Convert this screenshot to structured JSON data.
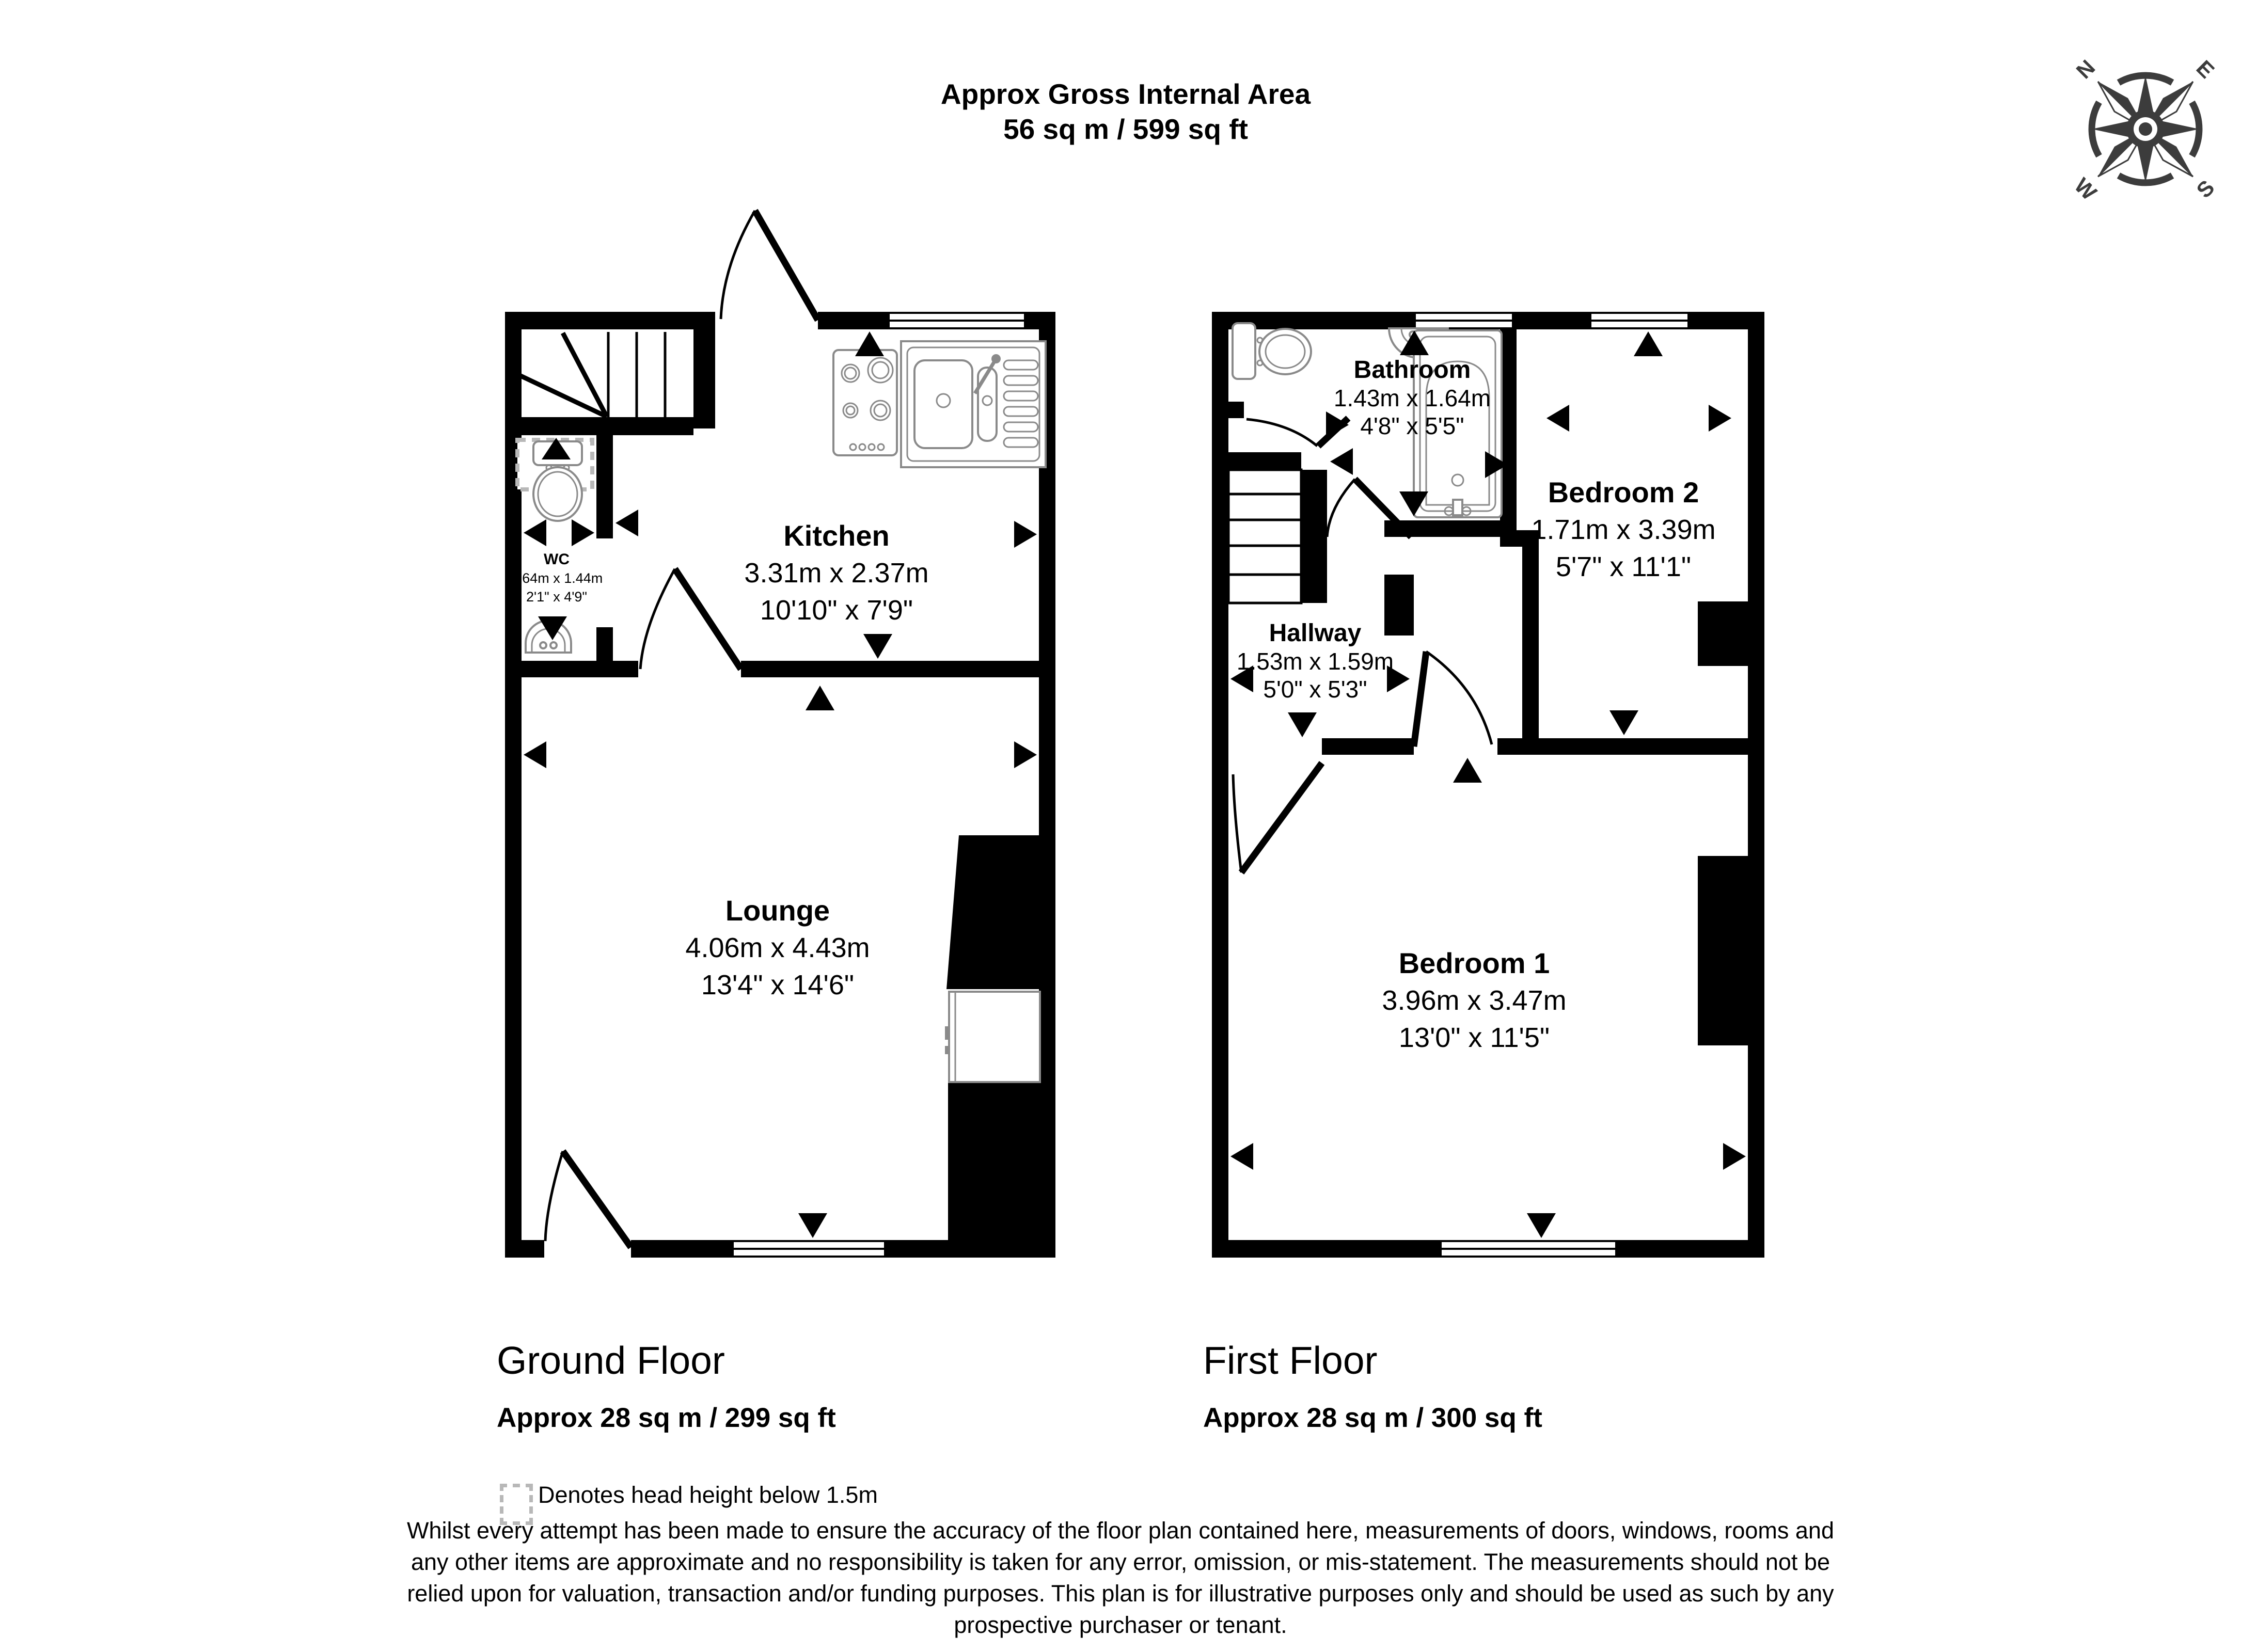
{
  "header": {
    "title_line1": "Approx Gross Internal Area",
    "title_line2": "56 sq m / 599 sq ft"
  },
  "compass": {
    "n": "N",
    "e": "E",
    "s": "S",
    "w": "W"
  },
  "ground_floor": {
    "name": "Ground Floor",
    "area": "Approx 28 sq m / 299 sq ft",
    "rooms": {
      "kitchen": {
        "name": "Kitchen",
        "metric": "3.31m x 2.37m",
        "imperial": "10'10\" x 7'9\""
      },
      "wc": {
        "name": "WC",
        "metric": "0.64m x 1.44m",
        "imperial": "2'1\" x 4'9\""
      },
      "lounge": {
        "name": "Lounge",
        "metric": "4.06m x 4.43m",
        "imperial": "13'4\" x 14'6\""
      }
    }
  },
  "first_floor": {
    "name": "First Floor",
    "area": "Approx 28 sq m / 300 sq ft",
    "rooms": {
      "bathroom": {
        "name": "Bathroom",
        "metric": "1.43m x 1.64m",
        "imperial": "4'8\" x 5'5\""
      },
      "bedroom2": {
        "name": "Bedroom 2",
        "metric": "1.71m x 3.39m",
        "imperial": "5'7\" x 11'1\""
      },
      "hallway": {
        "name": "Hallway",
        "metric": "1.53m x 1.59m",
        "imperial": "5'0\" x 5'3\""
      },
      "bedroom1": {
        "name": "Bedroom 1",
        "metric": "3.96m x 3.47m",
        "imperial": "13'0\" x 11'5\""
      }
    }
  },
  "legend": {
    "head_height": "Denotes head height below 1.5m"
  },
  "disclaimer": {
    "lines": [
      "Whilst every attempt has been made to ensure the accuracy of the floor plan contained here, measurements of doors, windows, rooms and",
      "any other items are approximate and no responsibility is taken for any error, omission, or mis-statement. The measurements should not be",
      "relied upon for valuation, transaction and/or funding purposes. This plan is for illustrative purposes only and should be used as such by any",
      "prospective purchaser or tenant."
    ]
  }
}
